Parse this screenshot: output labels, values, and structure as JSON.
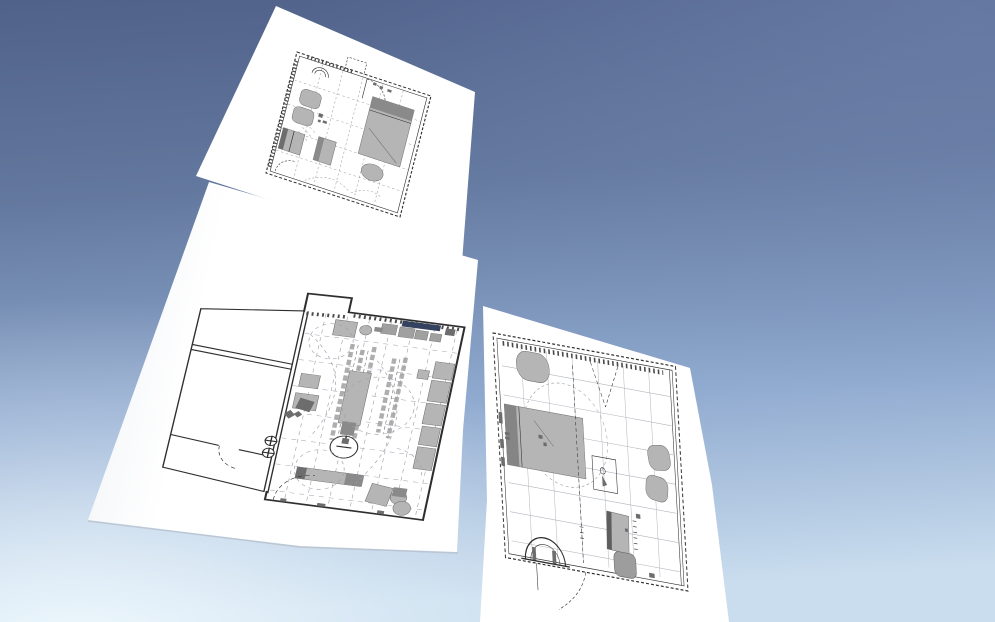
{
  "scene": {
    "description": "3D perspective view of three white paper sheets with architectural floor plans against a sky gradient",
    "sheets": [
      {
        "name": "bedroom floor plan (upper sheet)"
      },
      {
        "name": "apartment workshop floor plan (large center-left sheet)"
      },
      {
        "name": "bedroom floor plan (right sheet)"
      }
    ]
  },
  "colors": {
    "sky_top": "#50618a",
    "sky_upper_mid": "#64799f",
    "sky_lower_mid": "#8fa9cf",
    "sky_bottom": "#c9ddee",
    "sky_glow": "#f0f9fe",
    "paper": "#ffffff",
    "paper_shade": "#eef1f5",
    "paper_edge": "#b6bfcc",
    "ink": "#2e2e2e",
    "line_light": "#9ba1ab",
    "furniture": "#b5b5b5",
    "furniture_mid": "#a0a0a0",
    "furniture_dark": "#8a8a8a",
    "furniture_darker": "#6d6d6d",
    "navy": "#35425f"
  }
}
